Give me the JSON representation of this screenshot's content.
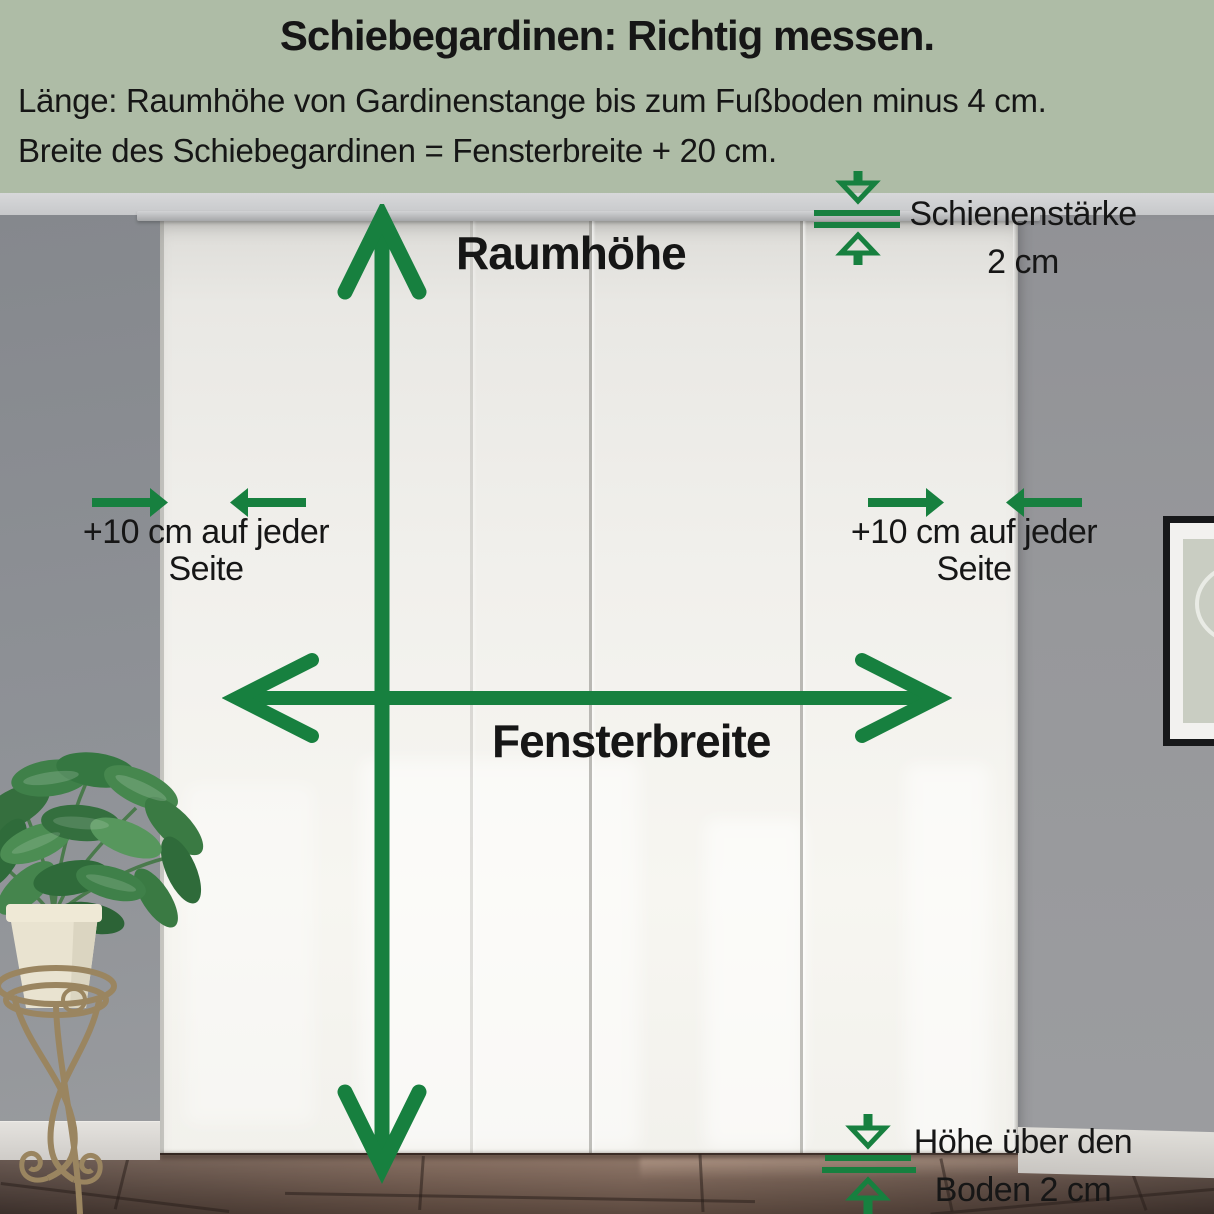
{
  "header": {
    "title": "Schiebegardinen: Richtig messen.",
    "line1": "Länge: Raumhöhe von Gardinenstange bis zum Fußboden minus 4 cm.",
    "line2": "Breite des Schiebegardinen = Fensterbreite + 20 cm."
  },
  "measurements": {
    "room_height_label": "Raumhöhe",
    "window_width_label": "Fensterbreite",
    "rail_thickness": {
      "line1": "Schienenstärke",
      "line2": "2 cm"
    },
    "side_allowance_left": {
      "line1": "+10 cm auf jeder",
      "line2": "Seite"
    },
    "side_allowance_right": {
      "line1": "+10 cm auf jeder",
      "line2": "Seite"
    },
    "floor_clearance": {
      "line1": "Höhe über den",
      "line2": "Boden 2 cm"
    }
  },
  "colors": {
    "header_background": "#aebca6",
    "arrow_green": "#17803f",
    "text_black": "#161616",
    "wall_gray": "#8d9095",
    "curtain_white": "#f4f3ef",
    "floor_brown": "#6a5348"
  }
}
